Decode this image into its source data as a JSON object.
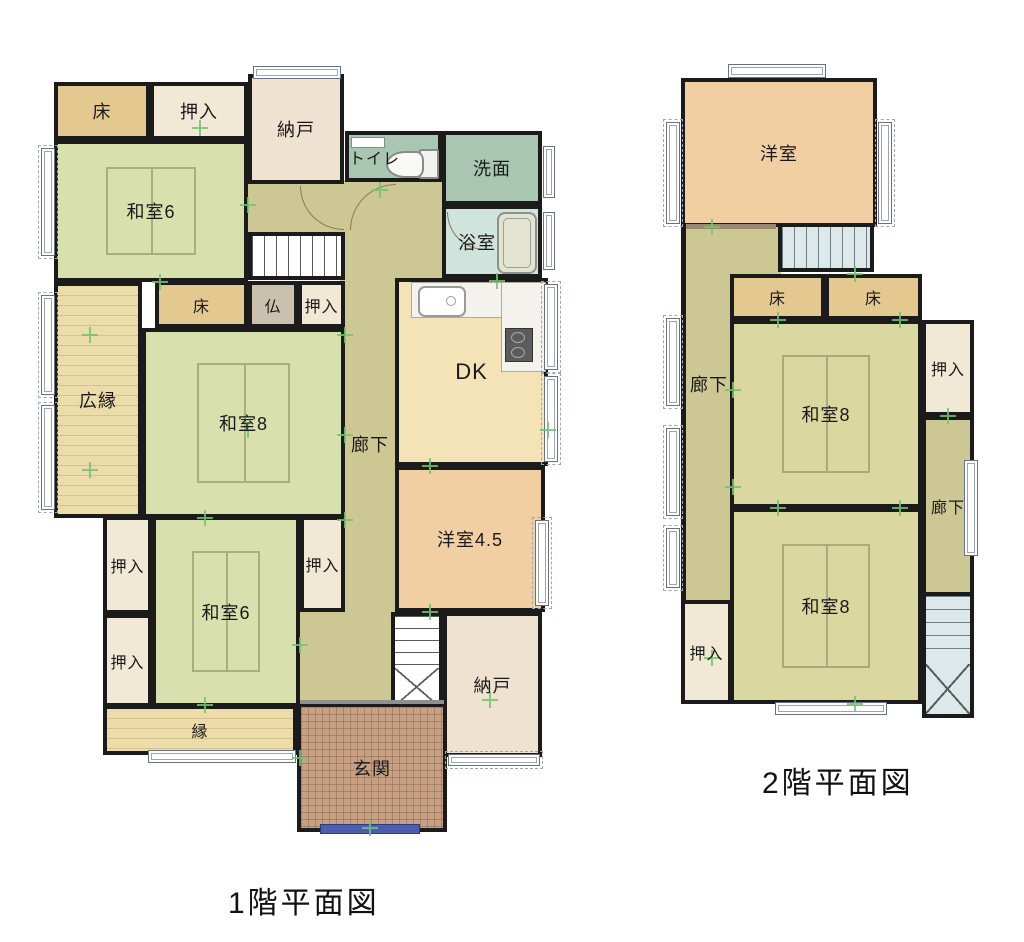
{
  "floor1": {
    "title": "1階平面図",
    "rooms": {
      "toko_top": "床",
      "oshiire_top": "押入",
      "nando_top": "納戸",
      "toilet": "トイレ",
      "senmen": "洗面",
      "yokushitsu": "浴室",
      "washitsu6_top": "和室6",
      "hiroen": "広縁",
      "toko_mid": "床",
      "butsudan": "仏",
      "oshiire_mid": "押入",
      "washitsu8": "和室8",
      "rouka": "廊下",
      "dk": "DK",
      "yoshitsu45": "洋室4.5",
      "oshiire_left_upper": "押入",
      "oshiire_left_lower": "押入",
      "washitsu6_bottom": "和室6",
      "oshiire_right": "押入",
      "en": "縁",
      "nando_bottom": "納戸",
      "genkan": "玄関"
    }
  },
  "floor2": {
    "title": "2階平面図",
    "rooms": {
      "yoshitsu": "洋室",
      "rouka_left": "廊下",
      "toko_left": "床",
      "toko_right": "床",
      "washitsu8_upper": "和室8",
      "oshiire_right": "押入",
      "rouka_right": "廊下",
      "washitsu8_lower": "和室8",
      "oshiire_bottom": "押入"
    }
  },
  "colors": {
    "wall": "#1b1b1b",
    "tatami_1f": "#d8e0ae",
    "tatami_2f": "#dbd7a0",
    "toko_alcove": "#e3c88f",
    "closet": "#f1e9d6",
    "storage": "#efe2d0",
    "wet_area": "#a9c6b2",
    "bathroom": "#cfe4dd",
    "dining_kitchen": "#f3e3b7",
    "western_room": "#f2cfa2",
    "corridor": "#cdc794",
    "veranda": "#ecdcaa",
    "entrance": "#c7a083",
    "grid_marker": "#72c472",
    "entry_door": "#4d5db0"
  }
}
